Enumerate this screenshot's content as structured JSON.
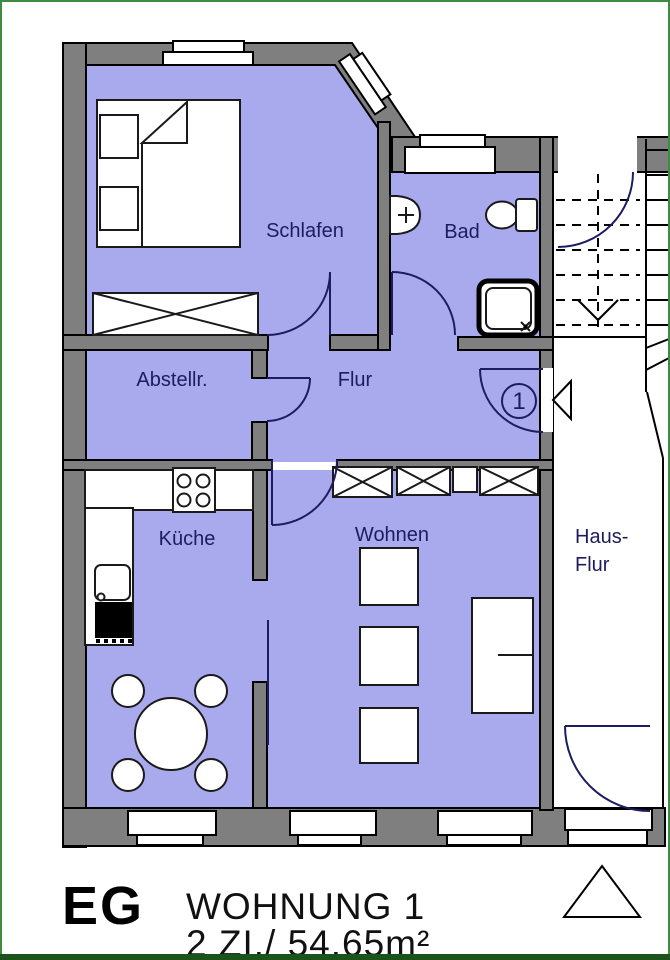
{
  "rooms": {
    "schlafen": {
      "label": "Schlafen"
    },
    "bad": {
      "label": "Bad"
    },
    "abstellraum": {
      "label": "Abstellr."
    },
    "flur": {
      "label": "Flur"
    },
    "kueche": {
      "label": "Küche"
    },
    "wohnen": {
      "label": "Wohnen"
    },
    "hausflur": {
      "label_line1": "Haus-",
      "label_line2": "Flur"
    }
  },
  "entrance": {
    "apartment_number": "1"
  },
  "footer": {
    "floor": "EG",
    "title": "WOHNUNG 1",
    "details": "2 ZI./ 54.65m²"
  },
  "colors": {
    "room_fill": "#a9a9ee",
    "wall_fill": "#7f7f7f",
    "outline": "#000000",
    "label_text": "#1c1c5e",
    "door_arc": "#1c1c5e",
    "page_border": "#3f8b3f",
    "page_border_bottom": "#1c521c"
  }
}
